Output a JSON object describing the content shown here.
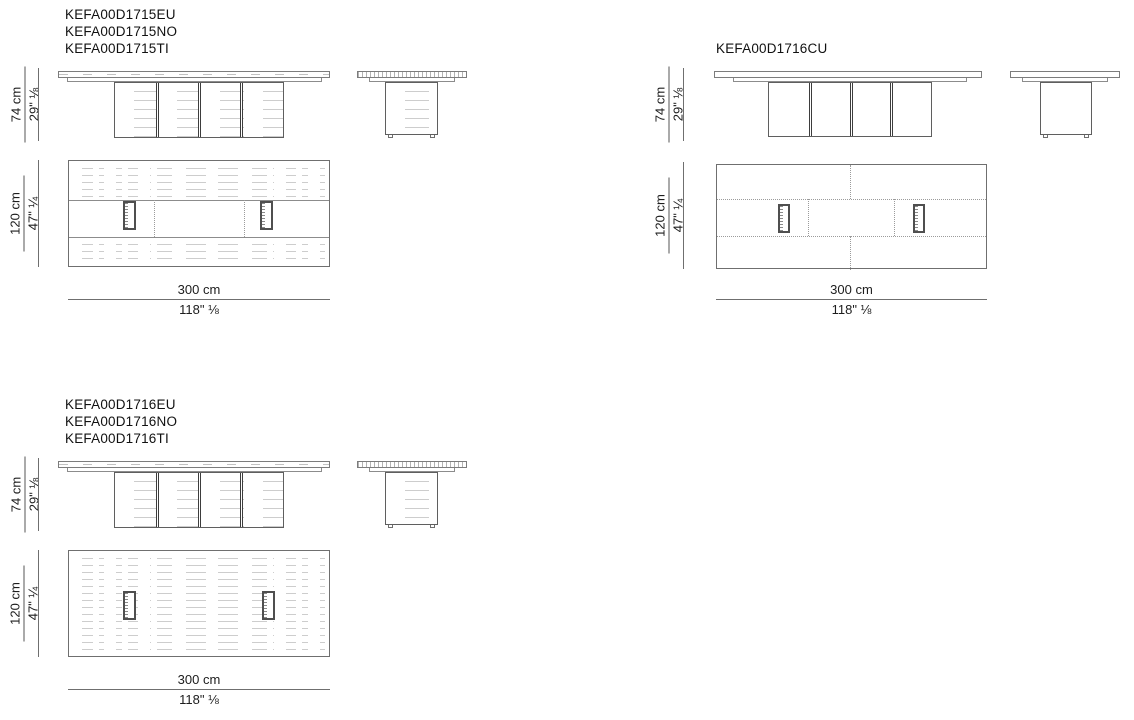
{
  "colors": {
    "background": "#ffffff",
    "line": "#7c7c7c",
    "dark_line": "#3d3d3d",
    "texture": "#cdcdcd",
    "dimension_line": "#6f6f6f",
    "text": "#1d1d1d"
  },
  "groups": [
    {
      "codes": [
        "KEFA00D1715EU",
        "KEFA00D1715NO",
        "KEFA00D1715TI"
      ],
      "height": {
        "metric": "74 cm",
        "imperial": "29\" ⅛"
      },
      "depth": {
        "metric": "120 cm",
        "imperial": "47\" ¼"
      },
      "width": {
        "metric": "300 cm",
        "imperial": "118\" ⅛"
      },
      "finish": "wood with center band"
    },
    {
      "codes": [
        "KEFA00D1716CU"
      ],
      "height": {
        "metric": "74 cm",
        "imperial": "29\" ⅛"
      },
      "depth": {
        "metric": "120 cm",
        "imperial": "47\" ¼"
      },
      "width": {
        "metric": "300 cm",
        "imperial": "118\" ⅛"
      },
      "finish": "plain with stitched seams"
    },
    {
      "codes": [
        "KEFA00D1716EU",
        "KEFA00D1716NO",
        "KEFA00D1716TI"
      ],
      "height": {
        "metric": "74 cm",
        "imperial": "29\" ⅛"
      },
      "depth": {
        "metric": "120 cm",
        "imperial": "47\" ¼"
      },
      "width": {
        "metric": "300 cm",
        "imperial": "118\" ⅛"
      },
      "finish": "full wood grain"
    }
  ]
}
